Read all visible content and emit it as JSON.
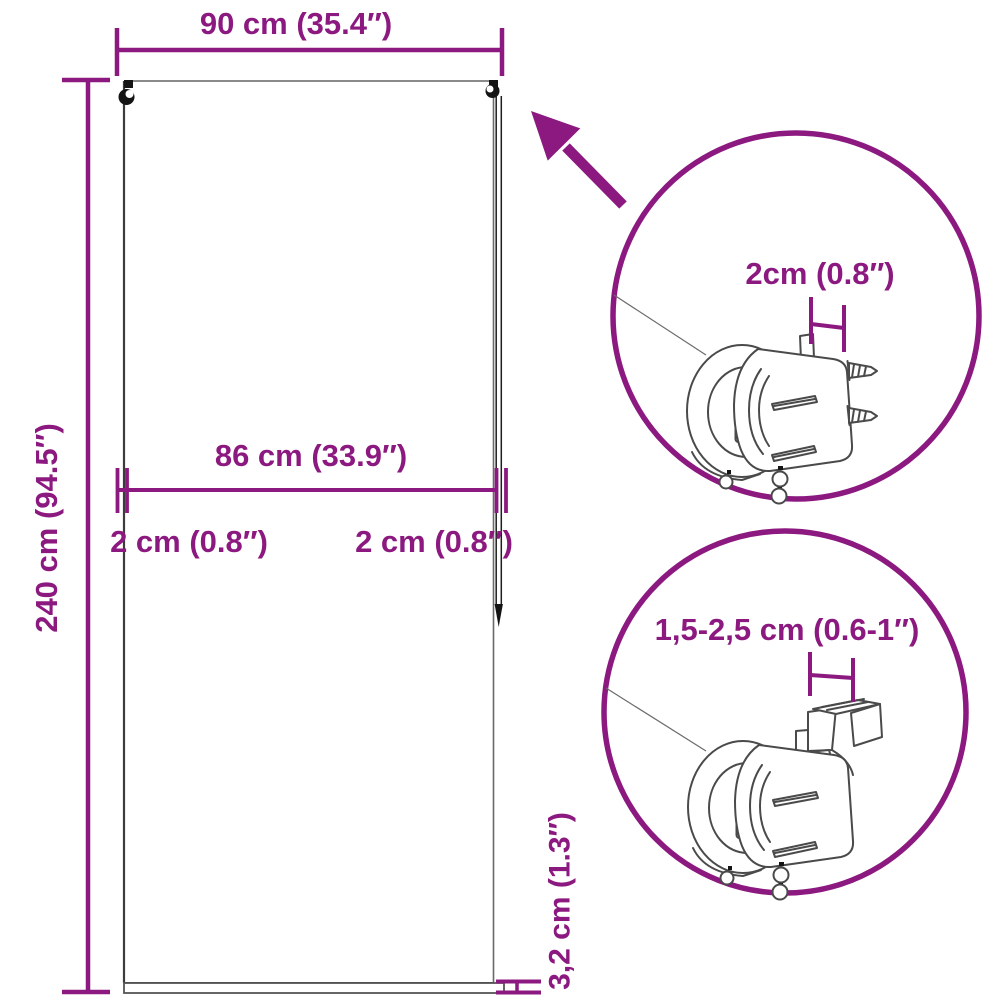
{
  "diagram": {
    "accent_color": "#8C1980",
    "labels": {
      "total_width": "90 cm (35.4″)",
      "total_height": "240 cm (94.5″)",
      "fabric_width": "86 cm (33.9″)",
      "left_offset": "2 cm (0.8″)",
      "right_offset": "2 cm (0.8″)",
      "bottom_bar": "3,2 cm (1.3″)",
      "detail_top_gap": "2cm (0.8″)",
      "detail_bottom_gap": "1,5-2,5 cm (0.6-1″)"
    },
    "icons": [
      "zoom-arrow-icon",
      "detail-circle-top",
      "detail-circle-bottom",
      "screw-bracket-icon",
      "clamp-bracket-icon",
      "pull-chain-icon"
    ]
  }
}
